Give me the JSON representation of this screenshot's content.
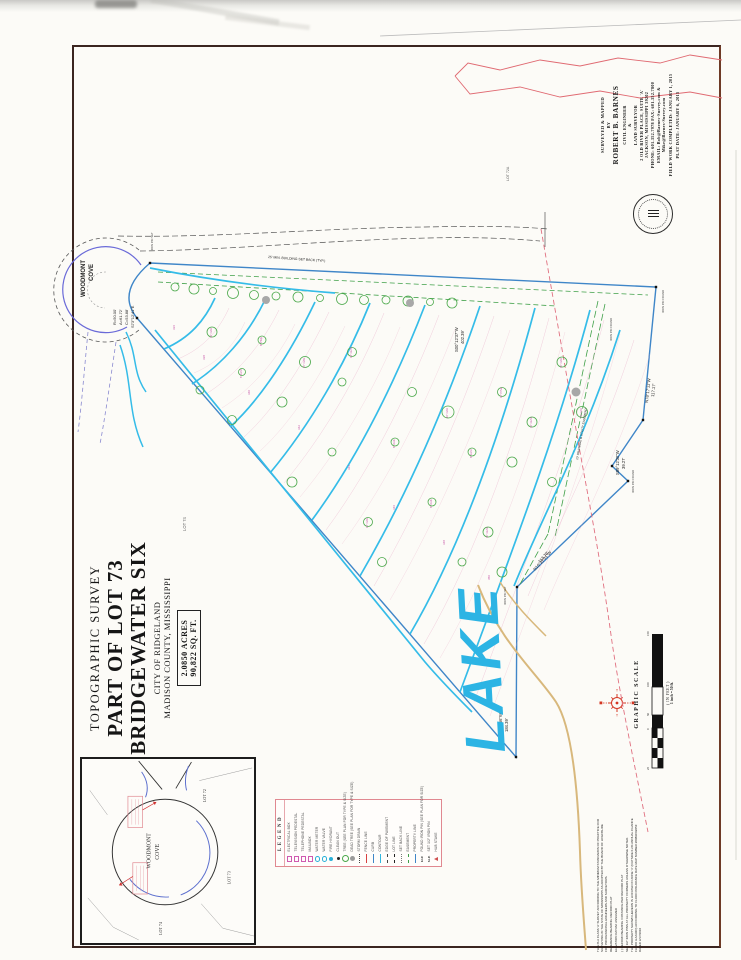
{
  "surveyor_block": {
    "lines": [
      "SURVEYED & MAPPED",
      "BY",
      "ROBERT B. BARNES",
      "CIVIL ENGINEER",
      "&",
      "LAND SURVEYOR",
      "2 OLD RIVER PLACE, SUITE 'A'",
      "JACKSON, MISSISSIPPI 39202",
      "PHONE: 601.352.7978  FAX: 601.352.7800",
      "EMAIL: Bob@Barnes-Survey.com &",
      "Mike@Barnes-Survey.com",
      "FIELD WORK COMPLETED: JANUARY 1, 2015",
      "PLAT DATE: JANUARY 6, 2015"
    ]
  },
  "title_block": {
    "survey_type": "TOPOGRAPHIC SURVEY",
    "lot_line": "PART OF LOT 73",
    "subdivision": "BRIDGEWATER SIX",
    "city": "CITY OF RIDGELAND",
    "county": "MADISON COUNTY, MISSISSIPPI",
    "acreage": "2.0850 ACRES",
    "square_feet": "90,822 SQ. FT."
  },
  "legend": {
    "title": "LEGEND",
    "items": [
      {
        "label": "ELECTRICAL BOX",
        "sym": "sqm"
      },
      {
        "label": "TELEVISION PEDESTAL",
        "sym": "sqm"
      },
      {
        "label": "TELEPHONE PEDESTAL",
        "sym": "sqm"
      },
      {
        "label": "MAILBOX",
        "sym": "sqm"
      },
      {
        "label": "WATER METER",
        "sym": "circ"
      },
      {
        "label": "WATER VALVE",
        "sym": "circ"
      },
      {
        "label": "FIRE HYDRANT",
        "sym": "hyd"
      },
      {
        "label": "CLEAN OUT",
        "sym": "dotk"
      },
      {
        "label": "TREE (SEE PLAN FOR TYPE & SIZE)",
        "sym": "treeg"
      },
      {
        "label": "DEAD TREE (SEE PLAN FOR TYPE & SIZE)",
        "sym": "treed"
      },
      {
        "label": "STORM DRAIN",
        "sym": "dotline"
      },
      {
        "label": "FENCE LINE",
        "sym": "linered"
      },
      {
        "label": "CURB",
        "sym": "lineblue"
      },
      {
        "label": "CONTOUR",
        "sym": "linecyan"
      },
      {
        "label": "EDGE OF PAVEMENT",
        "sym": "dashk"
      },
      {
        "label": "LOT LINE",
        "sym": "dashdot"
      },
      {
        "label": "SET BACK LINE",
        "sym": "dotted"
      },
      {
        "label": "EASEMENT",
        "sym": "dashg"
      },
      {
        "label": "PROPERTY LINE",
        "sym": "lineblue"
      },
      {
        "label": "FOUND IRON PIN (SEE PLAN FOR SIZE)",
        "sym": "fip",
        "mark": "F.I.P."
      },
      {
        "label": "SET 1/2\" IRON PIN",
        "sym": "sip",
        "mark": "S.I.P."
      },
      {
        "label": "HUB STAKE",
        "sym": "tri"
      }
    ]
  },
  "vicinity": {
    "street_line1": "WOODMONT",
    "street_line2": "COVE",
    "lot_72": "LOT 72",
    "lot_73": "LOT 73",
    "lot_74": "LOT 74"
  },
  "scale": {
    "title": "GRAPHIC SCALE",
    "unit_note": "( IN FEET )",
    "ratio_note": "1 inch = 50 ft.",
    "ticks": [
      "25",
      "0",
      "50",
      "100",
      "150"
    ]
  },
  "notes": {
    "p1": "THIS IS A CLASS 'A' SURVEY ACCORDING TO THE MINIMUM STANDARDS OF PRACTICE FOR SURVEYING IN THE STATE OF MISSISSIPPI AS ADOPTED BY THE BOARD OF LICENSURE FOR PROFESSIONAL ENGINEERS AND SURVEYORS.",
    "p2": "REFERENCE BEARING: RECORD PLAT",
    "p3": "ELEVATION DATUM: ASSUMED",
    "p4": "( ) RECORD BEARING / DISTANCE PER RECORD PLAT",
    "p5": "SET 1/2\" IRON PINS AT ALL PROPERTY CORNERS UNLESS OTHERWISE NOTED.",
    "p6": "THE PROPERTY SHOWN HEREON IS LOCATED IN ZONE 'X' (OUTSIDE 0.2% ANNUAL CHANCE FLOOD HAZARD) ACCORDING TO FLOOD INSURANCE RATE MAP NUMBER 28089C0205F DATED 3/17/2010"
  },
  "map": {
    "annotations": [
      {
        "t": "WOODMONT",
        "x": 85,
        "y": 297,
        "s": 6,
        "b": 1
      },
      {
        "t": "COVE",
        "x": 93,
        "y": 281,
        "s": 6,
        "b": 1
      },
      {
        "t": "R=50.00'",
        "x": 116,
        "y": 325,
        "s": 4
      },
      {
        "t": "A=61.72'",
        "x": 122,
        "y": 325,
        "s": 4
      },
      {
        "t": "C=53.88'",
        "x": 128,
        "y": 325,
        "s": 4
      },
      {
        "t": "S73°12'41\"E",
        "x": 134,
        "y": 328,
        "s": 4
      },
      {
        "t": "S00°12'37\"W",
        "x": 458,
        "y": 352,
        "s": 4.2
      },
      {
        "t": "402.39'",
        "x": 464,
        "y": 344,
        "s": 4.2
      },
      {
        "t": "N78°17'11\"W",
        "x": 648,
        "y": 403,
        "s": 4.2,
        "r": -84
      },
      {
        "t": "117.17'",
        "x": 654,
        "y": 397,
        "s": 4.2,
        "r": -84
      },
      {
        "t": "S89°12'30\"W",
        "x": 619,
        "y": 475,
        "s": 4.2
      },
      {
        "t": "39.27'",
        "x": 625,
        "y": 469,
        "s": 4.2
      },
      {
        "t": "N16°27'31\"W",
        "x": 535,
        "y": 571,
        "s": 4.2,
        "r": -48
      },
      {
        "t": "113.70'",
        "x": 540,
        "y": 563,
        "s": 4.2,
        "r": -48
      },
      {
        "t": "N89°13'56\"W",
        "x": 502,
        "y": 738,
        "s": 4.2
      },
      {
        "t": "184.39'",
        "x": 508,
        "y": 732,
        "s": 4.2
      },
      {
        "t": "LOT 72A",
        "x": 509,
        "y": 181,
        "s": 3.6,
        "c": "#666"
      },
      {
        "t": "LOT 74",
        "x": 186,
        "y": 531,
        "s": 4.2,
        "c": "#666"
      },
      {
        "t": "25' MIN. BUILDING SET BACK (TYP.)",
        "x": 268,
        "y": 258,
        "r": 4,
        "s": 3.4
      },
      {
        "t": "10' DRAINAGE & UTILITY EASEMENT",
        "x": 578,
        "y": 460,
        "r": -80,
        "s": 3
      },
      {
        "t": "IRON PIN FOUND",
        "x": 664,
        "y": 313,
        "s": 2.8,
        "c": "#444"
      },
      {
        "t": "IRON PIN FOUND",
        "x": 612,
        "y": 341,
        "s": 2.8,
        "c": "#444"
      },
      {
        "t": "IRON PIN FOUND",
        "x": 634,
        "y": 493,
        "s": 2.8,
        "c": "#444"
      },
      {
        "t": "IRON PIN SET",
        "x": 506,
        "y": 605,
        "s": 2.8,
        "c": "#444"
      },
      {
        "t": "IRON PIN SET",
        "x": 153,
        "y": 251,
        "s": 2.8,
        "c": "#444"
      },
      {
        "t": "LAKE",
        "x": 505,
        "y": 752,
        "s": 56,
        "c": "#2cb4e4",
        "r": -93,
        "b": 1,
        "i": 1,
        "ls": 4
      },
      {
        "t": "336",
        "x": 175,
        "y": 330,
        "s": 3,
        "c": "#c757a8"
      },
      {
        "t": "338",
        "x": 205,
        "y": 360,
        "s": 3,
        "c": "#c757a8"
      },
      {
        "t": "340",
        "x": 250,
        "y": 395,
        "s": 3,
        "c": "#c757a8"
      },
      {
        "t": "342",
        "x": 300,
        "y": 430,
        "s": 3,
        "c": "#c757a8"
      },
      {
        "t": "344",
        "x": 350,
        "y": 470,
        "s": 3,
        "c": "#c757a8"
      },
      {
        "t": "346",
        "x": 395,
        "y": 510,
        "s": 3,
        "c": "#c757a8"
      },
      {
        "t": "348",
        "x": 445,
        "y": 545,
        "s": 3,
        "c": "#c757a8"
      },
      {
        "t": "350",
        "x": 490,
        "y": 580,
        "s": 3,
        "c": "#c757a8"
      },
      {
        "t": "12\" OAK",
        "x": 212,
        "y": 338,
        "s": 2.6,
        "c": "#c757a8"
      },
      {
        "t": "8\" PINE",
        "x": 262,
        "y": 346,
        "s": 2.6,
        "c": "#c757a8"
      },
      {
        "t": "10\" OAK",
        "x": 305,
        "y": 368,
        "s": 2.6,
        "c": "#c757a8"
      },
      {
        "t": "14\" GUM",
        "x": 352,
        "y": 358,
        "s": 2.6,
        "c": "#c757a8"
      },
      {
        "t": "8\" OAK",
        "x": 395,
        "y": 448,
        "s": 2.6,
        "c": "#c757a8"
      },
      {
        "t": "16\" OAK",
        "x": 448,
        "y": 418,
        "s": 2.6,
        "c": "#c757a8"
      },
      {
        "t": "10\" PINE",
        "x": 502,
        "y": 398,
        "s": 2.6,
        "c": "#c757a8"
      },
      {
        "t": "12\" GUM",
        "x": 532,
        "y": 428,
        "s": 2.6,
        "c": "#c757a8"
      },
      {
        "t": "8\" ELM",
        "x": 472,
        "y": 458,
        "s": 2.6,
        "c": "#c757a8"
      },
      {
        "t": "10\" OAK",
        "x": 562,
        "y": 368,
        "s": 2.6,
        "c": "#c757a8"
      },
      {
        "t": "12\" OAK",
        "x": 368,
        "y": 528,
        "s": 2.6,
        "c": "#c757a8"
      },
      {
        "t": "8\" OAK",
        "x": 432,
        "y": 508,
        "s": 2.6,
        "c": "#c757a8"
      },
      {
        "t": "10\" GUM",
        "x": 488,
        "y": 538,
        "s": 2.6,
        "c": "#c757a8"
      },
      {
        "t": "14\" OAK",
        "x": 582,
        "y": 418,
        "s": 2.6,
        "c": "#c757a8"
      },
      {
        "t": "6\" ELM",
        "x": 242,
        "y": 378,
        "s": 2.6,
        "c": "#c757a8"
      }
    ],
    "art": {
      "paths": [
        {
          "d": "M150,263 L656,287 L643,420 L612,466 L628,481 L517,587 L516,757 L137,318 Q116,292 150,263 Z",
          "s": "#3f86c8",
          "w": 1.4
        },
        {
          "d": "M139,250 A52,52 0 1 0 139,330",
          "s": "#555",
          "w": 0.8,
          "da": "4 3"
        },
        {
          "d": "M141,265 A43,43 0 1 0 127,327",
          "s": "#6a6ad8",
          "w": 1.2
        },
        {
          "d": "M106,272 A18,18 0 1 0 105,308",
          "s": "#999",
          "w": 0.6,
          "da": "2 2"
        },
        {
          "d": "M118,236 C220,238 320,228 425,227 C475,226 515,226 548,229",
          "s": "#555",
          "w": 0.7,
          "da": "6 3"
        },
        {
          "d": "M140,251 C230,250 330,240 428,238 C470,237 505,238 540,241",
          "s": "#555",
          "w": 0.7,
          "da": "6 3"
        },
        {
          "d": "M545,212 L545,247",
          "s": "#555",
          "w": 0.7
        },
        {
          "d": "M158,272 L648,295",
          "s": "#3fa048",
          "w": 0.8,
          "da": "5 3"
        },
        {
          "d": "M158,282 L556,306",
          "s": "#3fa048",
          "w": 0.8,
          "da": "5 3"
        },
        {
          "d": "M598,301 L548,534",
          "s": "#3fa048",
          "w": 0.8,
          "da": "7 3"
        },
        {
          "d": "M605,304 L555,537",
          "s": "#3fa048",
          "w": 0.8,
          "da": "7 3"
        },
        {
          "d": "M548,534 L519,586",
          "s": "#3fa048",
          "w": 0.8,
          "da": "7 3"
        },
        {
          "d": "M150,268 C210,280 270,288 335,293",
          "s": "#35bce8",
          "w": 1.7
        },
        {
          "d": "M215,298 C205,320 190,338 164,349",
          "s": "#35bce8",
          "w": 1.7,
          "pk": 1
        },
        {
          "d": "M265,300 C248,335 222,365 192,384",
          "s": "#35bce8",
          "w": 1.7,
          "pk": 1
        },
        {
          "d": "M315,302 C292,350 262,398 230,427",
          "s": "#35bce8",
          "w": 1.7,
          "pk": 1
        },
        {
          "d": "M370,303 C345,365 310,425 270,473",
          "s": "#35bce8",
          "w": 1.7,
          "pk": 1
        },
        {
          "d": "M425,305 C398,375 360,455 312,520",
          "s": "#35bce8",
          "w": 1.7,
          "pk": 1
        },
        {
          "d": "M480,306 C450,395 410,490 360,576",
          "s": "#35bce8",
          "w": 1.7,
          "pk": 1
        },
        {
          "d": "M535,308 C505,420 465,540 410,634",
          "s": "#35bce8",
          "w": 1.7,
          "pk": 1
        },
        {
          "d": "M590,310 C558,430 520,530 460,692",
          "s": "#35bce8",
          "w": 1.7,
          "pk": 1
        },
        {
          "d": "M620,330 C585,440 545,510 514,586",
          "s": "#35bce8",
          "w": 1.7,
          "pk": 1
        },
        {
          "d": "M155,330 C240,435 330,545 425,662 C442,682 458,698 472,712",
          "s": "#35bce8",
          "w": 1.7
        },
        {
          "d": "M120,345 C133,382 127,412 143,447",
          "s": "#35bce8",
          "w": 1.5
        },
        {
          "d": "M126,332 C138,356 132,372 146,392",
          "s": "#35bce8",
          "w": 1.5
        },
        {
          "d": "M478,585 C500,642 536,672 556,702 C572,727 578,792 580,852 C581,888 584,922 586,950",
          "s": "#d8b87c",
          "w": 2
        },
        {
          "d": "M500,582 C514,604 530,620 546,636",
          "s": "#d8b87c",
          "w": 1.5
        },
        {
          "d": "M541,229 C552,292 566,372 580,452 C590,507 601,562 612,642 C621,702 636,772 648,832",
          "s": "#e07080",
          "w": 0.9,
          "da": "5 3"
        },
        {
          "d": "M88,332 C84,372 82,402 78,432",
          "s": "#8a8ad0",
          "w": 0.8,
          "da": "4 3"
        },
        {
          "d": "M116,342 C110,382 106,412 100,444",
          "s": "#8a8ad0",
          "w": 0.8,
          "da": "4 3"
        },
        {
          "d": "M380,36 L741,20",
          "s": "#bbbbbb",
          "w": 0.8
        },
        {
          "d": "M736,150 L736,860",
          "s": "#d8d8d2",
          "w": 1
        }
      ],
      "trees": [
        [
          175,
          287,
          4
        ],
        [
          194,
          289,
          5
        ],
        [
          213,
          291,
          3.5
        ],
        [
          233,
          293,
          5.5
        ],
        [
          254,
          295,
          4.5
        ],
        [
          276,
          296,
          4
        ],
        [
          298,
          297,
          5
        ],
        [
          320,
          298,
          3.5
        ],
        [
          342,
          299,
          5.5
        ],
        [
          364,
          300,
          4.5
        ],
        [
          386,
          300,
          4
        ],
        [
          408,
          301,
          5
        ],
        [
          430,
          302,
          3.5
        ],
        [
          452,
          303,
          5
        ],
        [
          212,
          332,
          5
        ],
        [
          262,
          340,
          4
        ],
        [
          305,
          362,
          5.5
        ],
        [
          352,
          352,
          4.5
        ],
        [
          395,
          442,
          4
        ],
        [
          448,
          412,
          6
        ],
        [
          502,
          392,
          4.5
        ],
        [
          532,
          422,
          5
        ],
        [
          472,
          452,
          4
        ],
        [
          562,
          362,
          5
        ],
        [
          368,
          522,
          4.5
        ],
        [
          432,
          502,
          4
        ],
        [
          488,
          532,
          5
        ],
        [
          582,
          412,
          5.5
        ],
        [
          242,
          372,
          3.5
        ],
        [
          232,
          420,
          4.5
        ],
        [
          282,
          402,
          5
        ],
        [
          332,
          452,
          4
        ],
        [
          292,
          482,
          5
        ],
        [
          412,
          392,
          4.5
        ],
        [
          342,
          382,
          4
        ],
        [
          512,
          462,
          5
        ],
        [
          552,
          482,
          4.5
        ],
        [
          462,
          562,
          4
        ],
        [
          502,
          572,
          5
        ],
        [
          382,
          562,
          4.5
        ],
        [
          200,
          390,
          4
        ],
        [
          266,
          300,
          4,
          1
        ],
        [
          410,
          303,
          4,
          1
        ],
        [
          576,
          392,
          4.5,
          1
        ]
      ],
      "pins": [
        [
          150,
          263
        ],
        [
          656,
          287
        ],
        [
          643,
          420
        ],
        [
          612,
          466
        ],
        [
          628,
          481
        ],
        [
          517,
          587
        ],
        [
          516,
          757
        ],
        [
          137,
          318
        ]
      ]
    }
  }
}
